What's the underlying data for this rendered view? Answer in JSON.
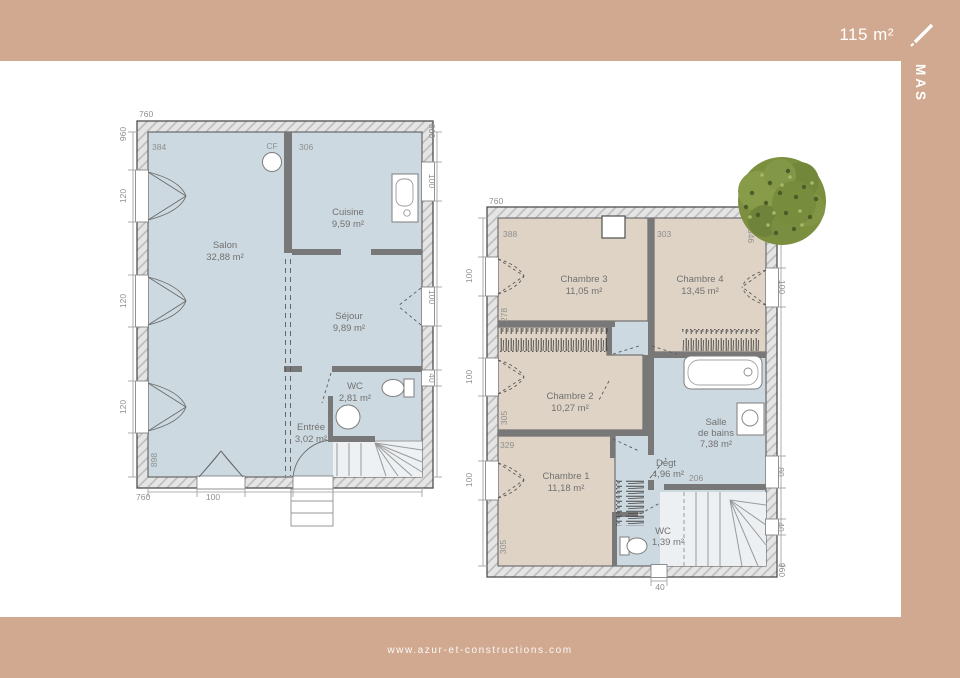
{
  "frame": {
    "area_label": "115 m²",
    "brand": "MAS",
    "website": "www.azur-et-constructions.com"
  },
  "colors": {
    "accent": "#d1a990",
    "floor_cool": "#cdd9e0",
    "floor_warm": "#ded3c5",
    "tree_green": "#7c8f3f"
  },
  "ground_floor": {
    "rooms": {
      "salon": {
        "name": "Salon",
        "area": "32,88 m²"
      },
      "cuisine": {
        "name": "Cuisine",
        "area": "9,59 m²"
      },
      "sejour": {
        "name": "Séjour",
        "area": "9,89 m²"
      },
      "wc": {
        "name": "WC",
        "area": "2,81 m²"
      },
      "entree": {
        "name": "Entrée",
        "area": "3,02 m²"
      }
    },
    "labels": {
      "cf": "CF"
    },
    "dims": {
      "top_width": "760",
      "left_height": "960",
      "left_win1": "120",
      "left_win2": "120",
      "left_win3": "120",
      "bottom_width": "760",
      "bottom_door": "100",
      "right_height": "960",
      "right_win1": "100",
      "right_win2": "100",
      "right_win3": "40",
      "salon_width": "384",
      "cuisine_width": "306",
      "salon_depth": "898"
    }
  },
  "upper_floor": {
    "rooms": {
      "chambre3": {
        "name": "Chambre 3",
        "area": "11,05 m²"
      },
      "chambre4": {
        "name": "Chambre 4",
        "area": "13,45 m²"
      },
      "chambre2": {
        "name": "Chambre 2",
        "area": "10,27 m²"
      },
      "chambre1": {
        "name": "Chambre 1",
        "area": "11,18 m²"
      },
      "salle_de_bains": {
        "name_line1": "Salle",
        "name_line2": "de bains",
        "area": "7,38 m²"
      },
      "degagement": {
        "name": "Dégt",
        "area": "4,96 m²"
      },
      "wc": {
        "name": "WC",
        "area": "1,39 m²"
      }
    },
    "dims": {
      "top_width": "760",
      "left_win1": "100",
      "left_win2": "100",
      "left_win3": "100",
      "right_win1": "100",
      "right_win2": "80",
      "right_win3": "40",
      "right_height": "960",
      "bottom_win": "40",
      "chambre3_width": "388",
      "chambre4_width": "303",
      "chambre3_depth": "278",
      "chambre2_depth": "305",
      "chambre1_width": "329",
      "chambre1_depth": "305",
      "chambre4_depth": "346",
      "stairs_width": "206"
    }
  }
}
